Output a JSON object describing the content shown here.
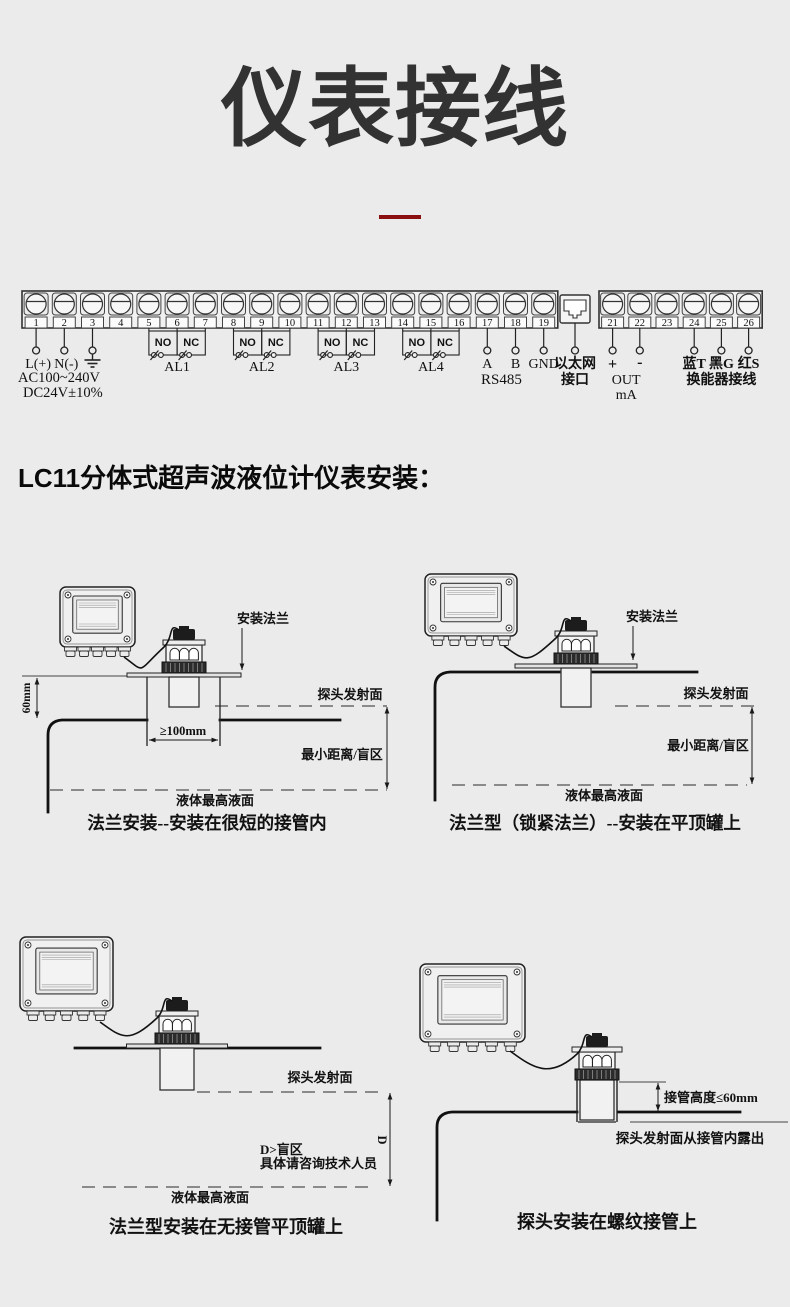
{
  "page": {
    "title": "仪表接线",
    "background": "#ebebeb",
    "divider_color": "#8c0f0f",
    "ink": "#111111"
  },
  "section_heading": "LC11分体式超声波液位计仪表安装：",
  "wiring": {
    "blocks": [
      {
        "terminals": [
          "1",
          "2",
          "3",
          "4",
          "5",
          "6",
          "7",
          "8",
          "9",
          "10",
          "11",
          "12",
          "13",
          "14",
          "15",
          "16",
          "17",
          "18",
          "19"
        ]
      },
      {
        "terminals": [
          "21",
          "22",
          "23",
          "24",
          "25",
          "26"
        ]
      }
    ],
    "power": {
      "live": "L(+)",
      "neutral": "N(-)",
      "earth_icon": "earth-ground-icon",
      "supply_line1": "AC100~240V",
      "supply_line2": "DC24V±10%"
    },
    "relays": [
      {
        "no": "NO",
        "nc": "NC",
        "name": "AL1"
      },
      {
        "no": "NO",
        "nc": "NC",
        "name": "AL2"
      },
      {
        "no": "NO",
        "nc": "NC",
        "name": "AL3"
      },
      {
        "no": "NO",
        "nc": "NC",
        "name": "AL4"
      }
    ],
    "rs485": {
      "a": "A",
      "b": "B",
      "label": "RS485"
    },
    "gnd": "GND",
    "ethernet": {
      "line1": "以太网",
      "line2": "接口"
    },
    "current_loop": {
      "plus": "+",
      "minus": "-",
      "line1": "OUT",
      "line2": "mA"
    },
    "transducer": {
      "blue": "蓝T",
      "black": "黑G",
      "red": "红S",
      "label": "换能器接线"
    }
  },
  "diagrams": [
    {
      "caption": "法兰安装--安装在很短的接管内",
      "labels": {
        "flange": "安装法兰",
        "emit_face": "探头发射面",
        "min_dist": "最小距离/盲区",
        "liquid_max": "液体最高液面",
        "nozzle_height": "60mm",
        "nozzle_width": "≥100mm"
      }
    },
    {
      "caption": "法兰型（锁紧法兰）--安装在平顶罐上",
      "labels": {
        "flange": "安装法兰",
        "emit_face": "探头发射面",
        "min_dist": "最小距离/盲区",
        "liquid_max": "液体最高液面"
      }
    },
    {
      "caption": "法兰型安装在无接管平顶罐上",
      "labels": {
        "emit_face": "探头发射面",
        "blind_line1": "D>盲区",
        "blind_line2": "具体请咨询技术人员",
        "dim_d": "D",
        "liquid_max": "液体最高液面"
      }
    },
    {
      "caption": "探头安装在螺纹接管上",
      "labels": {
        "pipe_height": "接管高度≤60mm",
        "emit_expose": "探头发射面从接管内露出"
      }
    }
  ]
}
